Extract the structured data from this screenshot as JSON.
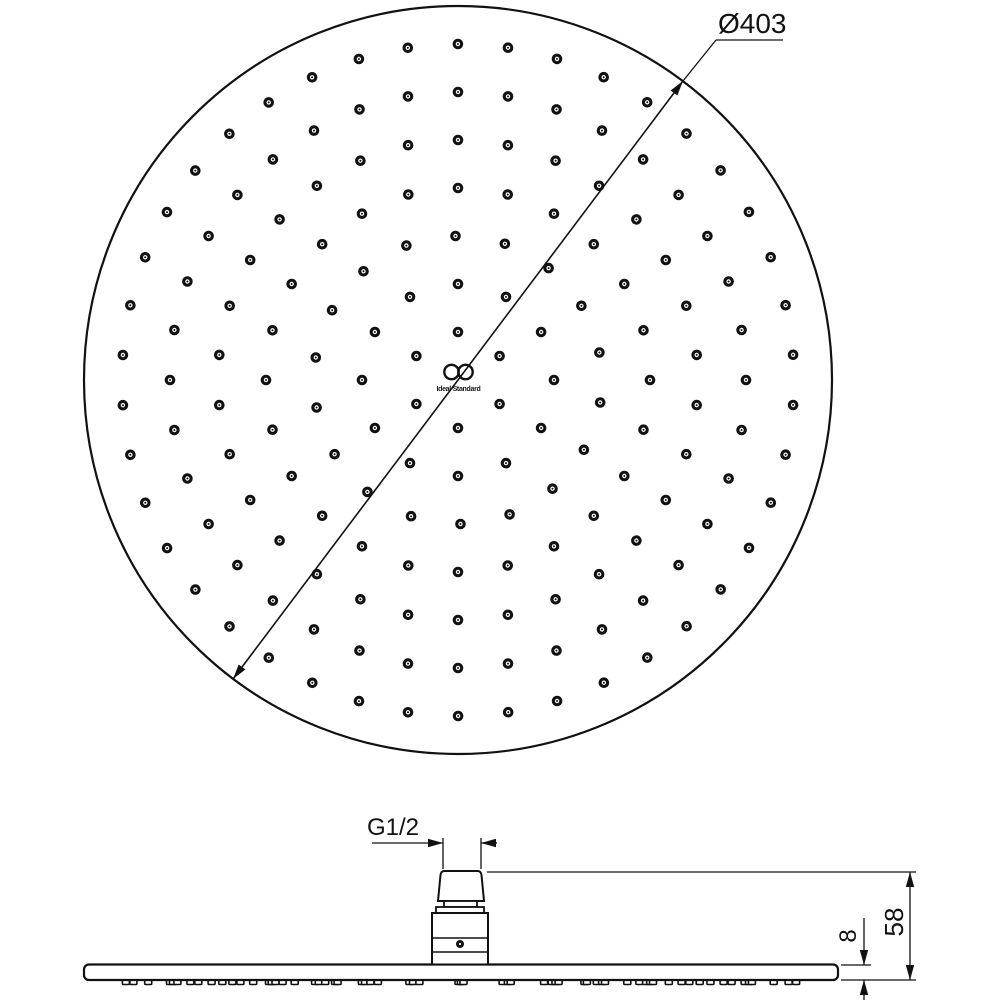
{
  "drawing": {
    "background_color": "#ffffff",
    "line_color": "#111111",
    "brand": {
      "logo_text": "Ideal Standard"
    },
    "top_view": {
      "diameter_label": "Ø403",
      "diameter_mm": 403,
      "nozzle_rings": [
        {
          "radius_px": 48,
          "count": 6,
          "start_deg": 30
        },
        {
          "radius_px": 96,
          "count": 12,
          "start_deg": 0
        },
        {
          "radius_px": 144,
          "count": 18,
          "start_deg": 11
        },
        {
          "radius_px": 192,
          "count": 24,
          "start_deg": 0
        },
        {
          "radius_px": 240,
          "count": 30,
          "start_deg": 6
        },
        {
          "radius_px": 288,
          "count": 36,
          "start_deg": 0
        },
        {
          "radius_px": 336,
          "count": 42,
          "start_deg": 4.3
        }
      ]
    },
    "side_view": {
      "thread_label": "G1/2",
      "height_label": "58",
      "plate_thickness_label": "8"
    }
  }
}
